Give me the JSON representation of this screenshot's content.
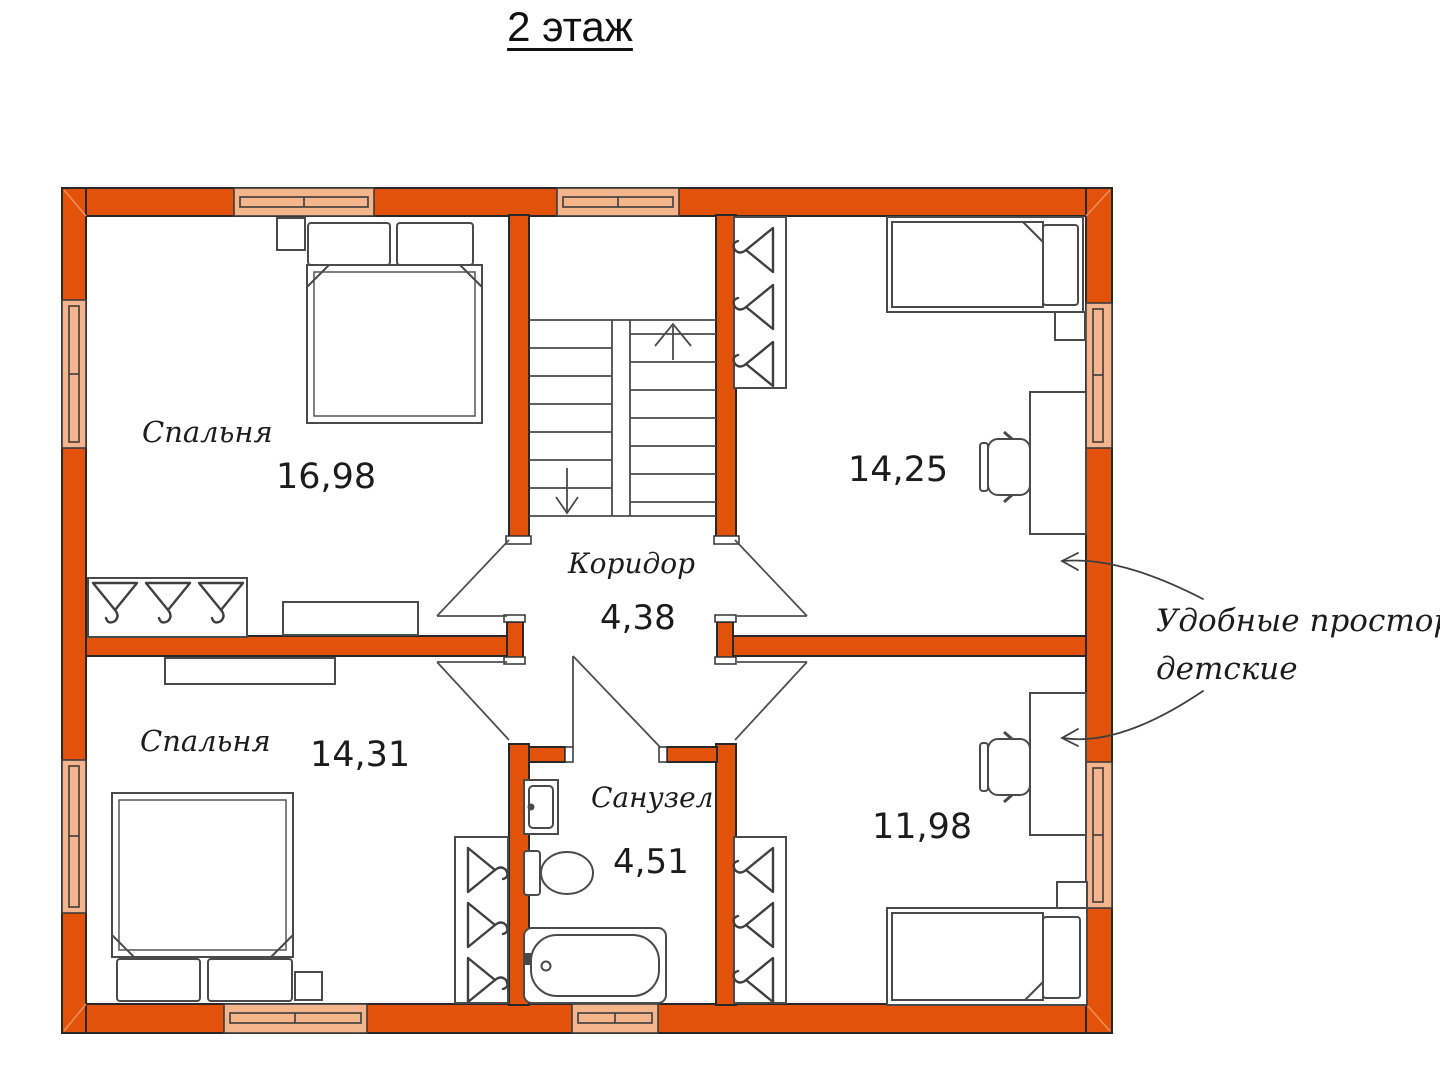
{
  "title": "2 этаж",
  "colors": {
    "wall": "#e2520a",
    "window": "#f4b58c",
    "line": "#3f3f3f",
    "background": "#ffffff"
  },
  "rooms": {
    "bedroom_top_left": {
      "name": "Спальня",
      "area": "16,98"
    },
    "nursery_top_right": {
      "area": "14,25"
    },
    "corridor": {
      "name": "Коридор",
      "area": "4,38"
    },
    "bedroom_bottom_left": {
      "name": "Спальня",
      "area": "14,31"
    },
    "bathroom": {
      "name": "Санузел",
      "area": "4,51"
    },
    "nursery_bottom_right": {
      "area": "11,98"
    }
  },
  "annotation": {
    "line1": "Удобные просторные",
    "line2": "детские"
  }
}
